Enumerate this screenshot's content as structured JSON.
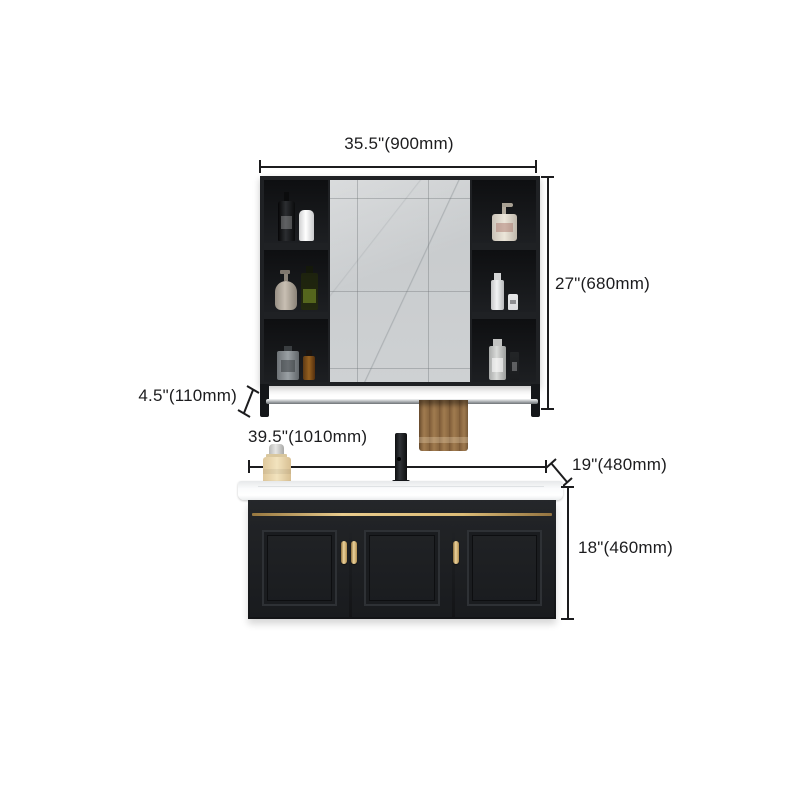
{
  "product": {
    "title": "Bathroom vanity set with mirror cabinet — dimension diagram"
  },
  "dimensions": {
    "mirror_cabinet_width": "35.5\"(900mm)",
    "mirror_cabinet_height": "27\"(680mm)",
    "towel_rail_drop": "4.5\"(110mm)",
    "vanity_width": "39.5\"(1010mm)",
    "vanity_depth": "19\"(480mm)",
    "vanity_height": "18\"(460mm)"
  },
  "colors": {
    "background": "#ffffff",
    "dimension_ink": "#1c1c1e",
    "cabinet_black": "#1f2124",
    "mirror_gray": "#c9ccce",
    "gold_accent": "#dcbc77",
    "towel_brown": "#8a6740",
    "counter_white": "#fafbfc"
  },
  "scene": {
    "mirror_cabinet": {
      "left_shelf_items": [
        "black pump bottle",
        "white cylinder bottle",
        "taupe soap dispenser",
        "olive glass bottle",
        "gray square cologne bottle",
        "amber bottle"
      ],
      "right_shelf_items": [
        "cream pump jar",
        "white spray bottle",
        "white tube",
        "gray spray bottle",
        "black slim bottle"
      ],
      "accessories": [
        "chrome towel rail",
        "brown hand towel"
      ]
    },
    "vanity": {
      "features": [
        "white ceramic sink top",
        "black matte faucet",
        "cream canister",
        "gold trim strip",
        "three framed doors",
        "gold bar handles"
      ]
    }
  }
}
